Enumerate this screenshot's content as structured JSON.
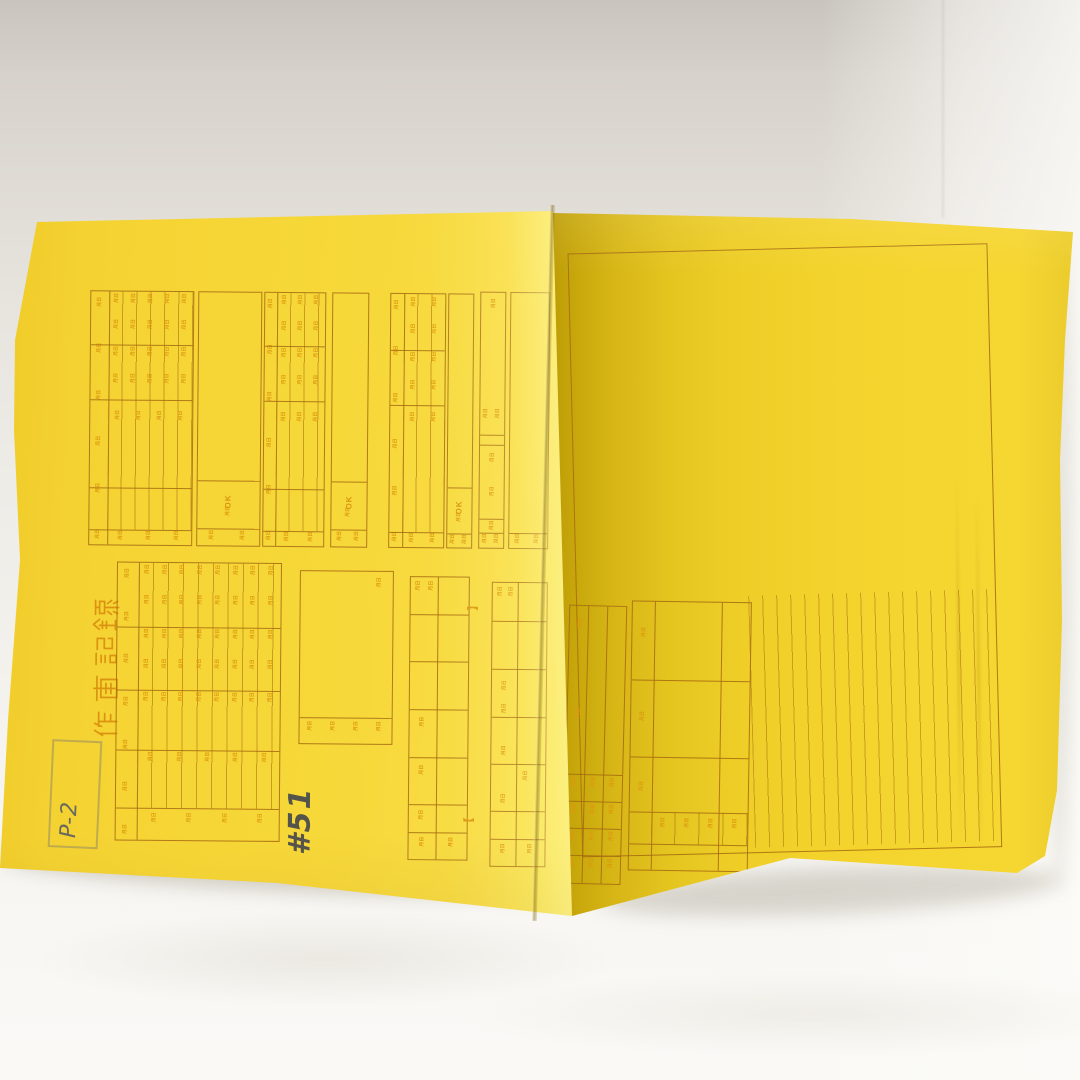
{
  "document": {
    "title": "作画記録",
    "handwritten_episode_number": "#51",
    "handwritten_part_code": "P-2",
    "ok_label": "OK",
    "date_cell_mark": "月日",
    "bracket_open": "【",
    "bracket_close": "】"
  },
  "colors": {
    "paper_yellow": "#f6d431",
    "paper_highlight": "#fbe554",
    "paper_fold_shadow": "#c6a60c",
    "print_line": "#a46a10",
    "print_text": "#dd980f",
    "pencil_gray": "#55544b",
    "backdrop_top": "#d2cec7",
    "backdrop_bottom": "#f8f7f4"
  }
}
